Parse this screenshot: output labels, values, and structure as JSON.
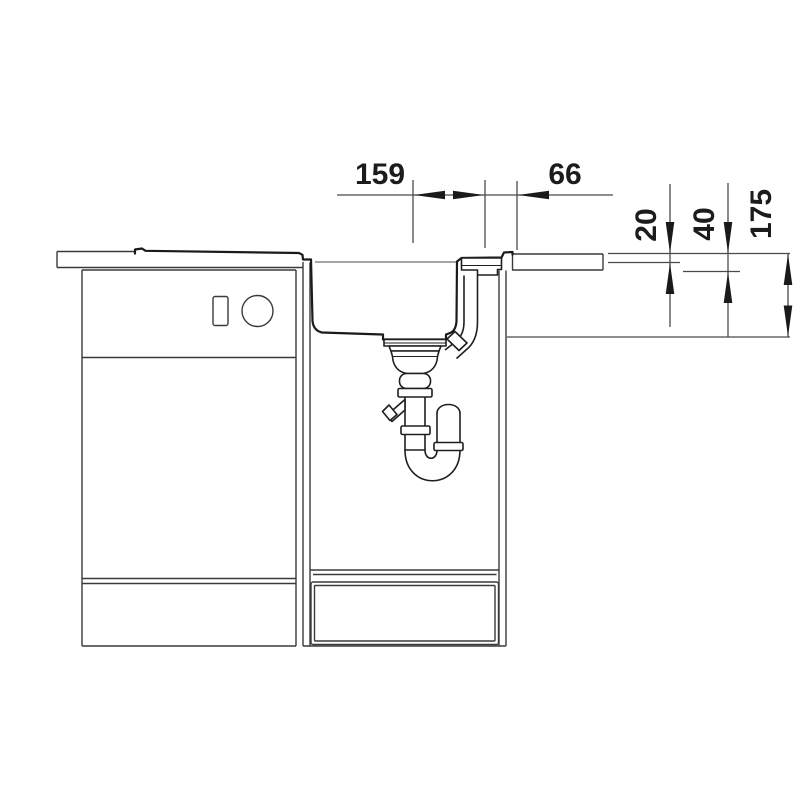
{
  "drawing": {
    "kind": "sink-installation-cross-section",
    "colors": {
      "background": "#ffffff",
      "thin_line": "#3a3a3a",
      "thick_line": "#1a1a1a",
      "arrow": "#1a1a1a"
    },
    "dims": {
      "d159": "159",
      "d66": "66",
      "d20": "20",
      "d40": "40",
      "d175": "175"
    },
    "dimensions_meaning": {
      "horizontal": [
        {
          "label": "159",
          "measures": "drain-center-to-offset-point"
        },
        {
          "label": "66",
          "measures": "offset-point-to-sink-right-edge"
        }
      ],
      "vertical": [
        {
          "label": "20",
          "measures": "rim-step-below-worktop"
        },
        {
          "label": "40",
          "measures": "worktop-thickness"
        },
        {
          "label": "175",
          "measures": "bowl-depth"
        }
      ]
    }
  }
}
